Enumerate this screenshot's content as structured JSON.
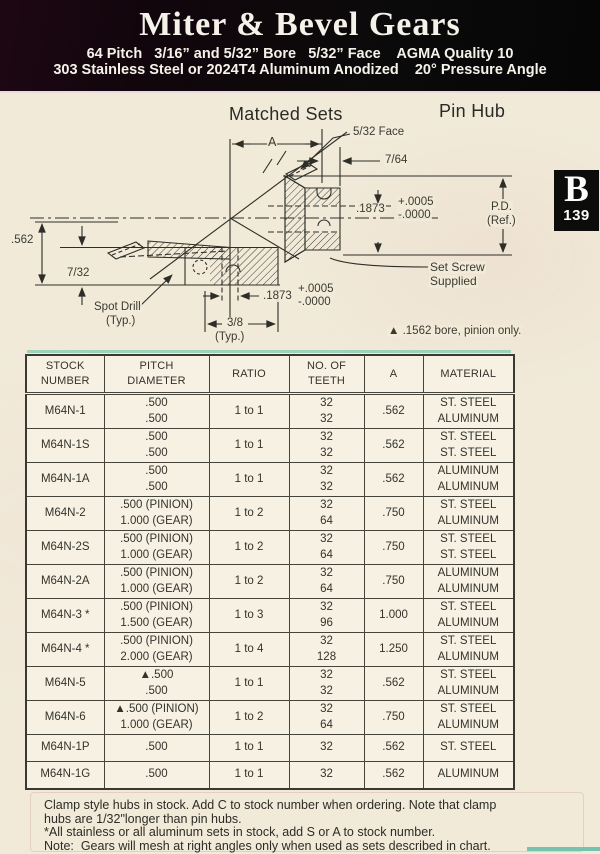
{
  "header": {
    "title": "Miter & Bevel Gears",
    "line1": "64 Pitch   3/16” and 5/32” Bore   5/32” Face    AGMA Quality 10",
    "line2": "303 Stainless Steel or 2024T4 Aluminum Anodized    20° Pressure Angle"
  },
  "page_tab": {
    "letter": "B",
    "number": "139"
  },
  "drawing": {
    "labels": [
      {
        "name": "matched-sets-title",
        "text": "Matched Sets",
        "x": 228,
        "y": 10,
        "size": 18
      },
      {
        "name": "pin-hub-title",
        "text": "Pin Hub",
        "x": 438,
        "y": 7,
        "size": 18
      },
      {
        "name": "face-dim",
        "text": "5/32 Face",
        "x": 352,
        "y": 31,
        "size": 11.5
      },
      {
        "name": "a-dim",
        "text": "A",
        "x": 267,
        "y": 41,
        "size": 12.5
      },
      {
        "name": "hub-proj-dim",
        "text": "7/64",
        "x": 384,
        "y": 59,
        "size": 11.5
      },
      {
        "name": "bore-dim-upper",
        "text": ".1873",
        "x": 355,
        "y": 108,
        "size": 11.5
      },
      {
        "name": "bore-tol-plus-upper",
        "text": "+.0005",
        "x": 397,
        "y": 101,
        "size": 11.5
      },
      {
        "name": "bore-tol-minus-upper",
        "text": "-.0000",
        "x": 397,
        "y": 114,
        "size": 11.5
      },
      {
        "name": "pd-label",
        "text": "P.D.",
        "x": 490,
        "y": 106,
        "size": 11.5
      },
      {
        "name": "pd-ref-label",
        "text": "(Ref.)",
        "x": 486,
        "y": 120,
        "size": 11.5
      },
      {
        "name": "od-dim",
        "text": ".562",
        "x": 10,
        "y": 139,
        "size": 11.5
      },
      {
        "name": "hub-height-dim",
        "text": "7/32",
        "x": 66,
        "y": 172,
        "size": 11.5
      },
      {
        "name": "spot-drill-label",
        "text": "Spot Drill",
        "x": 93,
        "y": 206,
        "size": 11.5
      },
      {
        "name": "spot-drill-typ",
        "text": "(Typ.)",
        "x": 105,
        "y": 220,
        "size": 11.5
      },
      {
        "name": "bore-dim-lower",
        "text": ".1873",
        "x": 262,
        "y": 195,
        "size": 11.5
      },
      {
        "name": "bore-tol-plus-lower",
        "text": "+.0005",
        "x": 297,
        "y": 188,
        "size": 11.5
      },
      {
        "name": "bore-tol-minus-lower",
        "text": "-.0000",
        "x": 297,
        "y": 201,
        "size": 11.5
      },
      {
        "name": "hub-width-dim",
        "text": "3/8",
        "x": 226,
        "y": 222,
        "size": 11.5
      },
      {
        "name": "hub-width-typ",
        "text": "(Typ.)",
        "x": 214,
        "y": 236,
        "size": 11.5
      },
      {
        "name": "set-screw-label-1",
        "text": "Set Screw",
        "x": 429,
        "y": 166,
        "size": 12
      },
      {
        "name": "set-screw-label-2",
        "text": "Supplied",
        "x": 429,
        "y": 180,
        "size": 12
      },
      {
        "name": "pinion-bore-note",
        "text": "▲ .1562 bore, pinion only.",
        "x": 387,
        "y": 230,
        "size": 11.5
      }
    ]
  },
  "table": {
    "columns": [
      "STOCK\nNUMBER",
      "PITCH\nDIAMETER",
      "RATIO",
      "NO. OF\nTEETH",
      "A",
      "MATERIAL"
    ],
    "rows": [
      {
        "stock": "M64N-1",
        "pitch": ".500\n.500",
        "ratio": "1 to 1",
        "teeth": "32\n32",
        "a": ".562",
        "material": "ST. STEEL\nALUMINUM"
      },
      {
        "stock": "M64N-1S",
        "pitch": ".500\n.500",
        "ratio": "1 to 1",
        "teeth": "32\n32",
        "a": ".562",
        "material": "ST. STEEL\nST. STEEL"
      },
      {
        "stock": "M64N-1A",
        "pitch": ".500\n.500",
        "ratio": "1 to 1",
        "teeth": "32\n32",
        "a": ".562",
        "material": "ALUMINUM\nALUMINUM"
      },
      {
        "stock": "M64N-2",
        "pitch": ".500 (PINION)\n1.000 (GEAR)",
        "ratio": "1 to 2",
        "teeth": "32\n64",
        "a": ".750",
        "material": "ST. STEEL\nALUMINUM"
      },
      {
        "stock": "M64N-2S",
        "pitch": ".500 (PINION)\n1.000 (GEAR)",
        "ratio": "1 to 2",
        "teeth": "32\n64",
        "a": ".750",
        "material": "ST. STEEL\nST. STEEL"
      },
      {
        "stock": "M64N-2A",
        "pitch": ".500 (PINION)\n1.000 (GEAR)",
        "ratio": "1 to 2",
        "teeth": "32\n64",
        "a": ".750",
        "material": "ALUMINUM\nALUMINUM"
      },
      {
        "stock": "M64N-3 *",
        "pitch": ".500 (PINION)\n1.500 (GEAR)",
        "ratio": "1 to 3",
        "teeth": "32\n96",
        "a": "1.000",
        "material": "ST. STEEL\nALUMINUM"
      },
      {
        "stock": "M64N-4 *",
        "pitch": ".500 (PINION)\n2.000 (GEAR)",
        "ratio": "1 to 4",
        "teeth": "32\n128",
        "a": "1.250",
        "material": "ST. STEEL\nALUMINUM"
      },
      {
        "stock": "M64N-5",
        "pitch": "▲.500\n.500",
        "ratio": "1 to 1",
        "teeth": "32\n32",
        "a": ".562",
        "material": "ST. STEEL\nALUMINUM"
      },
      {
        "stock": "M64N-6",
        "pitch": "▲.500 (PINION)\n1.000 (GEAR)",
        "ratio": "1 to 2",
        "teeth": "32\n64",
        "a": ".750",
        "material": "ST. STEEL\nALUMINUM"
      },
      {
        "stock": "M64N-1P",
        "pitch": ".500",
        "ratio": "1 to 1",
        "teeth": "32",
        "a": ".562",
        "material": "ST. STEEL"
      },
      {
        "stock": "M64N-1G",
        "pitch": ".500",
        "ratio": "1 to 1",
        "teeth": "32",
        "a": ".562",
        "material": "ALUMINUM"
      }
    ]
  },
  "notes": [
    "Clamp style hubs in stock. Add C to stock number when ordering. Note that clamp",
    "hubs are 1/32\"longer than pin hubs.",
    "*All stainless or all aluminum sets in stock, add S or A to stock number.",
    "Note:  Gears will mesh at right angles only when used as sets described in chart."
  ]
}
